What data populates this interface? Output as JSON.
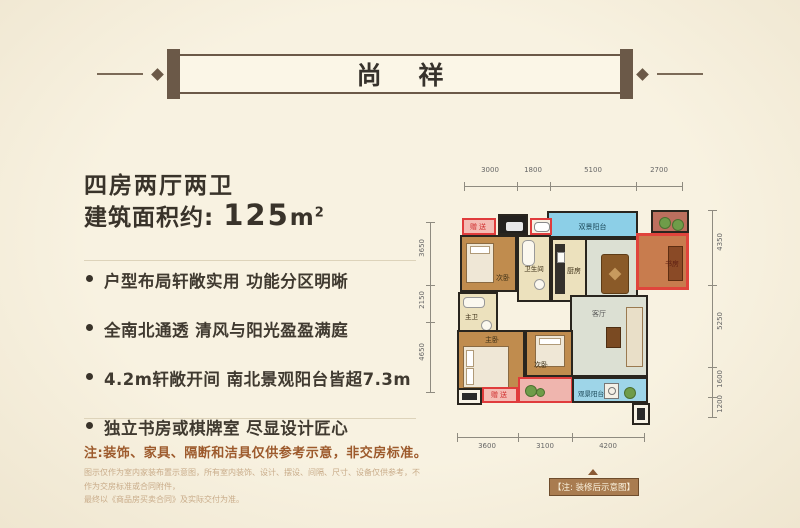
{
  "banner": {
    "title": "尚 祥"
  },
  "left_panel": {
    "headline": "四房两厅两卫",
    "area_label": "建筑面积约:",
    "area_value": "125",
    "area_unit": "m",
    "area_exponent": "2",
    "bullets": [
      "户型布局轩敞实用  功能分区明晰",
      "全南北通透  清风与阳光盈盈满庭",
      "4.2m轩敞开间  南北景观阳台皆超7.3m",
      "独立书房或棋牌室  尽显设计匠心"
    ],
    "note": "注:装饰、家具、隔断和洁具仅供参考示意，非交房标准。",
    "disclaimer_line1": "图示仅作为室内家装布置示意图，所有室内装饰、设计、摆设、间隔、尺寸、设备仅供参考，不作为交房标准或合同附件，",
    "disclaimer_line2": "最终以《商品房买卖合同》及实际交付为准。"
  },
  "floorplan": {
    "dims_top": [
      "3000",
      "1800",
      "5100",
      "2700"
    ],
    "dims_bottom": [
      "3600",
      "3100",
      "4200"
    ],
    "dims_right": [
      "4350",
      "5250",
      "1600",
      "1200"
    ],
    "dims_left": [
      "3650",
      "2150",
      "4650"
    ],
    "rooms": {
      "balcony_top": "双景阳台",
      "bedroom_top": "次卧",
      "bathroom": "卫生间",
      "kitchen": "厨房",
      "dining": "餐厅",
      "study": "书房",
      "master_bath": "主卫",
      "master_bedroom": "主卧",
      "bedroom_bottom": "次卧",
      "living": "客厅",
      "balcony_bottom": "观景阳台"
    },
    "gift_label_top": "赠送",
    "gift_label_bottom": "赠送",
    "caption": "【注: 装修后示意图】"
  },
  "colors": {
    "background": "#f7f0df",
    "banner_brown": "#6b5948",
    "accent_red": "#e03c3c",
    "note_brown": "#9d5a2c",
    "balcony_blue": "#8ccfe7",
    "caption_bg": "#a97c50"
  }
}
